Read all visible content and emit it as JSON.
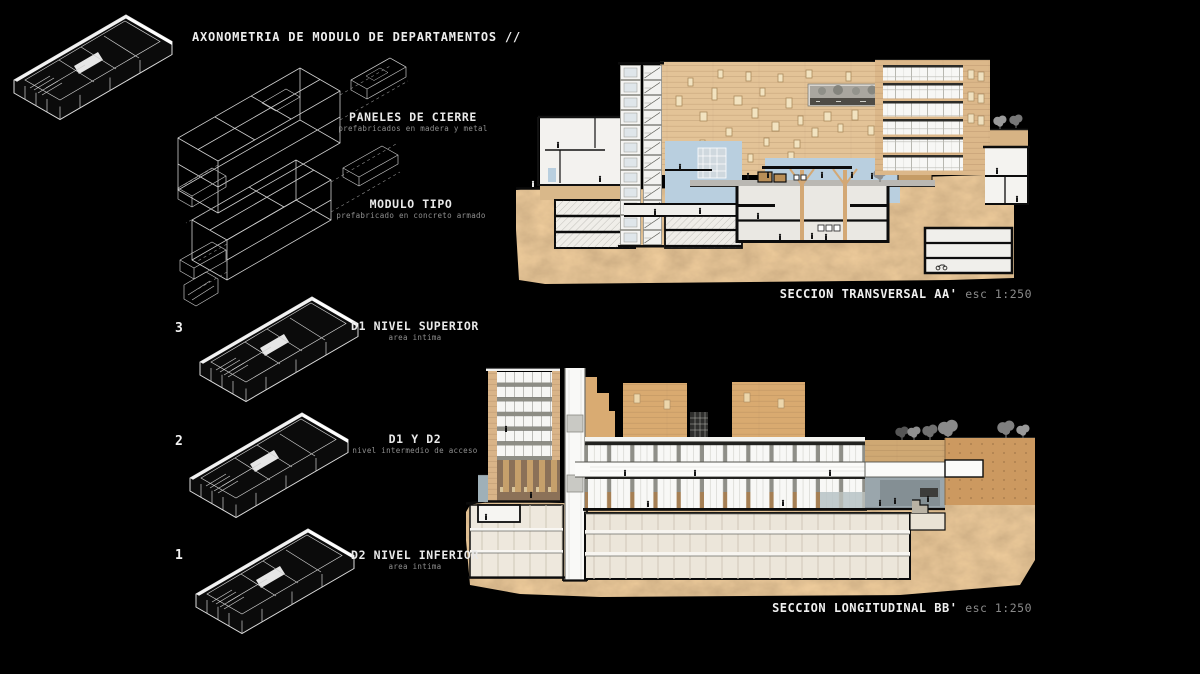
{
  "board": {
    "title": "AXONOMETRIA DE MODULO DE DEPARTAMENTOS //"
  },
  "axonometry": {
    "exploded_labels": [
      {
        "label": "PANELES DE CIERRE",
        "sublabel": "prefabricados en madera y metal"
      },
      {
        "label": "MODULO TIPO",
        "sublabel": "prefabricado en concreto armado"
      }
    ],
    "levels": [
      {
        "number": "3",
        "label": "D1 NIVEL SUPERIOR",
        "sublabel": "area intima"
      },
      {
        "number": "2",
        "label": "D1 Y D2",
        "sublabel": "nivel intermedio de acceso"
      },
      {
        "number": "1",
        "label": "D2 NIVEL INFERIOR",
        "sublabel": "area intima"
      }
    ]
  },
  "sections": [
    {
      "title": "SECCION TRANSVERSAL AA'",
      "scale": "esc 1:250"
    },
    {
      "title": "SECCION LONGITUDINAL BB'",
      "scale": "esc 1:250"
    }
  ],
  "palette": {
    "background": "#000000",
    "earth": "#b98a54",
    "facade_tan": "#e3c397",
    "building_tan": "#dcb88a",
    "concrete_orange": "#cc9960",
    "interior_white": "#f4f3f0",
    "accent_blue": "#b9cfdf",
    "slab_dark": "#1a1a18",
    "pier_brown": "#a57f54",
    "wireframe": "#d6d6d6",
    "text_grey": "#8f8f8f"
  }
}
